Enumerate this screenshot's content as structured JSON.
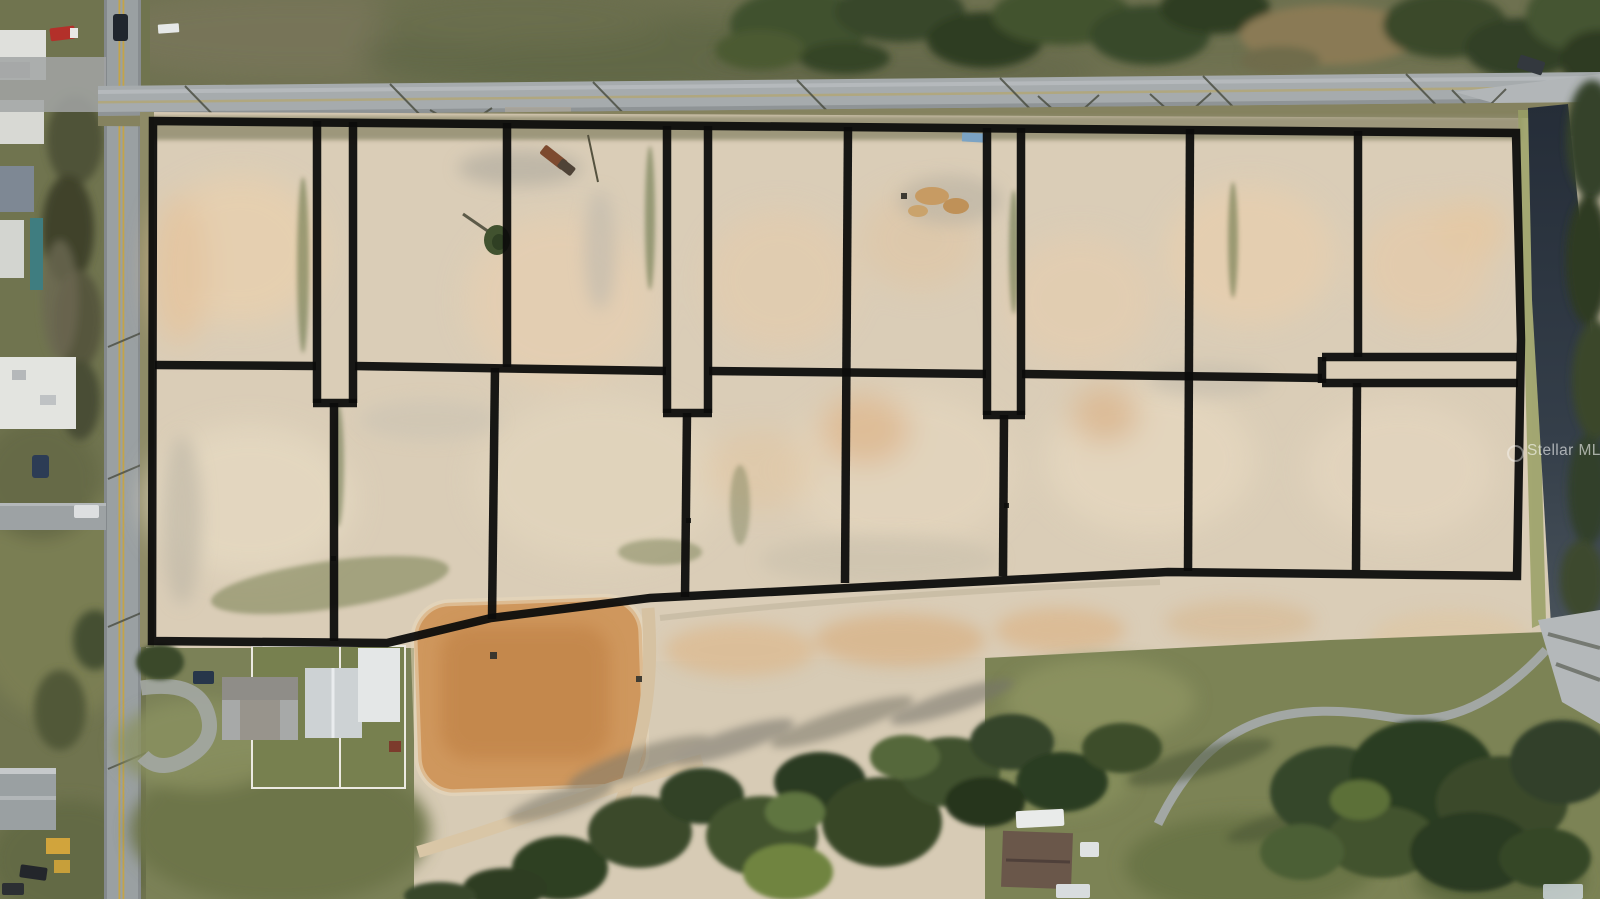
{
  "meta": {
    "type": "aerial-drone-photo",
    "subject": "cleared vacant land subdivision with black lot-boundary overlay, roads, homestead and tree lines"
  },
  "watermark": {
    "text": "Stellar MLS"
  },
  "palette": {
    "boundary_line": "#0d0d0c",
    "sand": "#d7cbb5",
    "grass_top": "#6e7150",
    "lawn": "#7a8155",
    "asphalt": "#a4a9ab",
    "yellow_line": "#c9a43e",
    "dirt_pad": "#cf975d",
    "tree": "#3c4c2c",
    "shadowed_road": "#2c3540"
  },
  "parcel": {
    "stroke": "#0d0d0c",
    "stroke_width": 8.5,
    "opacity": 0.95,
    "outer": "153,121 1516,133 1521,340 1517,576 1168,572 650,598 491,618 387,643 152,641",
    "segments": [
      {
        "name": "mid-line-a",
        "points": "155,365 316,366"
      },
      {
        "name": "mid-line-b",
        "points": "355,366 666,371"
      },
      {
        "name": "mid-line-c",
        "points": "709,371 986,374"
      },
      {
        "name": "mid-line-d",
        "points": "1022,374 1322,378"
      },
      {
        "name": "corridor1-left",
        "points": "317,121 317,403"
      },
      {
        "name": "corridor1-right",
        "points": "353,122 353,403"
      },
      {
        "name": "corridor1-bottom",
        "points": "313,403 357,403"
      },
      {
        "name": "lot-divider-b1-b2",
        "points": "334,403 334,641"
      },
      {
        "name": "lot-divider-t2-t3",
        "points": "507,123 507,367"
      },
      {
        "name": "lot-divider-b2-b3",
        "points": "495,368 492,619"
      },
      {
        "name": "corridor2-left",
        "points": "667,126 667,413"
      },
      {
        "name": "corridor2-right",
        "points": "708,126 708,413"
      },
      {
        "name": "corridor2-bottom",
        "points": "663,413 712,413"
      },
      {
        "name": "lot-divider-b3-b4",
        "points": "687,413 685,597"
      },
      {
        "name": "lot-divider-t4-t5",
        "points": "848,127 845,583"
      },
      {
        "name": "corridor3-left",
        "points": "987,128 987,415"
      },
      {
        "name": "corridor3-right",
        "points": "1021,128 1021,415"
      },
      {
        "name": "corridor3-bottom",
        "points": "983,415 1025,415"
      },
      {
        "name": "lot-divider-b5-b6",
        "points": "1004,415 1003,576"
      },
      {
        "name": "lot-divider-t6-t7",
        "points": "1190,129 1188,571"
      },
      {
        "name": "lot-divider-t7-t8",
        "points": "1358,131 1358,357"
      },
      {
        "name": "east-corridor-top",
        "points": "1322,357 1517,357"
      },
      {
        "name": "east-corridor-bottom",
        "points": "1322,383 1518,383"
      },
      {
        "name": "east-corridor-cap",
        "points": "1322,357 1322,383"
      },
      {
        "name": "lot-divider-b7-b8",
        "points": "1357,383 1356,570"
      }
    ]
  }
}
